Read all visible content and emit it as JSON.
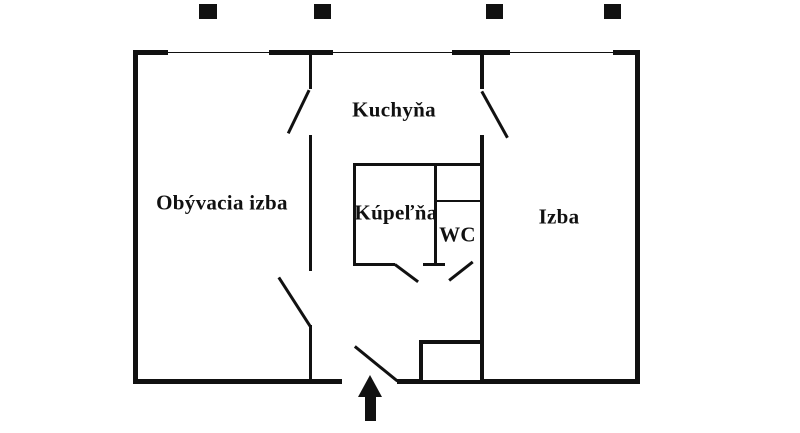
{
  "diagram": {
    "type": "apartment-floor-plan",
    "rooms": [
      {
        "id": "obyvacia-izba",
        "label": "Obývacia izba"
      },
      {
        "id": "kuchyna",
        "label": "Kuchyňa"
      },
      {
        "id": "kupelna",
        "label": "Kúpeľňa"
      },
      {
        "id": "wc",
        "label": "WC"
      },
      {
        "id": "izba",
        "label": "Izba"
      }
    ],
    "entrance_arrow": {
      "direction": "up"
    },
    "colors": {
      "wall": "#111111",
      "background": "#ffffff",
      "text": "#111111"
    }
  }
}
